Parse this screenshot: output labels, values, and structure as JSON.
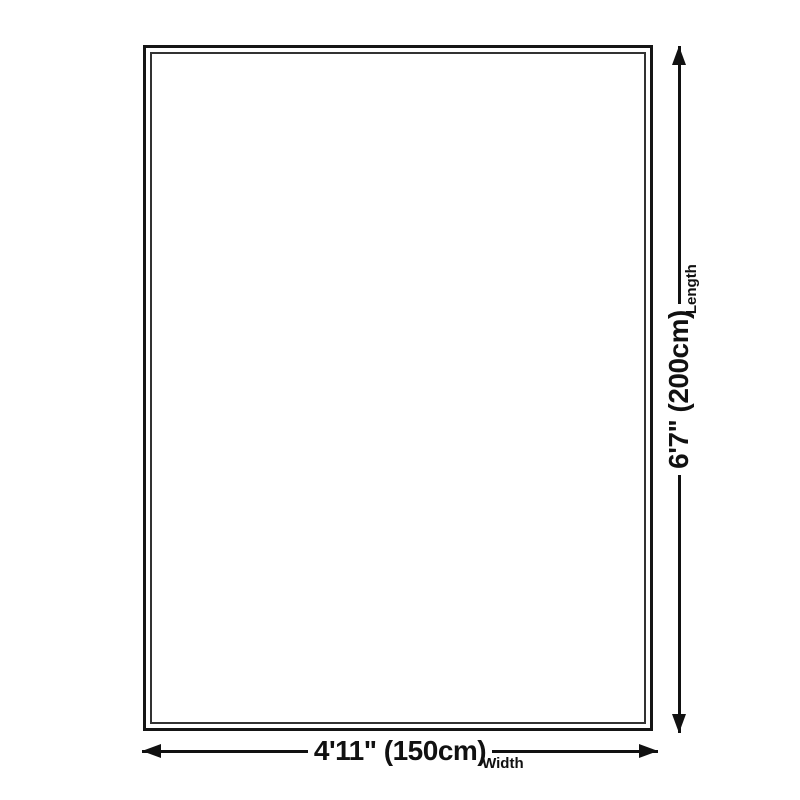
{
  "dimensions": {
    "width": {
      "value": "4'11\" (150cm)",
      "label": "Width"
    },
    "length": {
      "value": "6'7\" (200cm)",
      "label": "Length"
    }
  },
  "colors": {
    "ink": "#111111",
    "outer_border": "#151515",
    "inner_border": "#333333",
    "background": "#ffffff"
  }
}
